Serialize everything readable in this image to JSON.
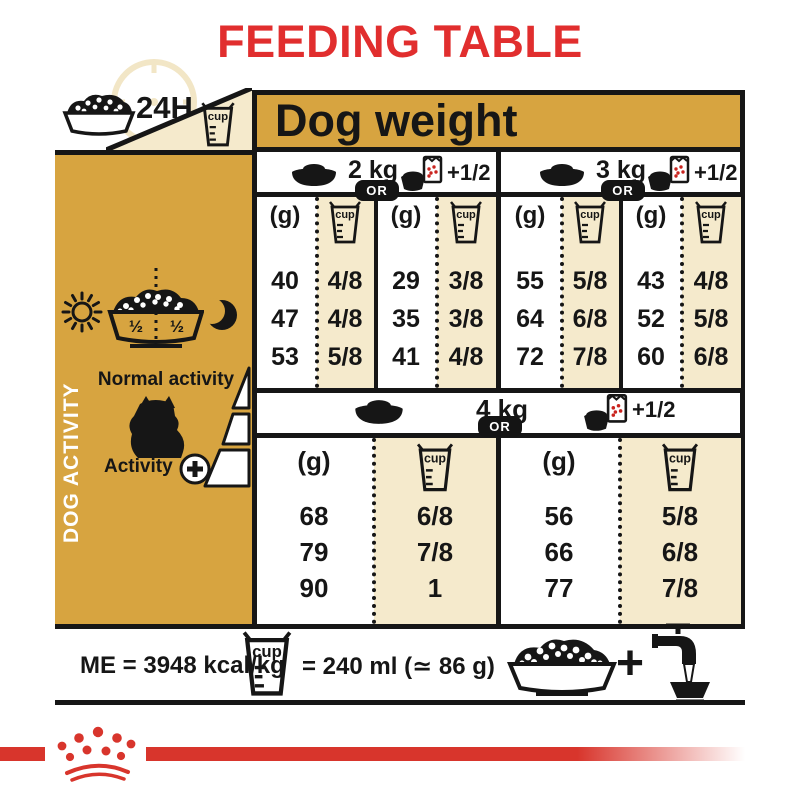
{
  "title": "FEEDING TABLE",
  "labels": {
    "hours": "24H",
    "cup": "cup",
    "dog_weight": "Dog weight",
    "unit_g": "(g)",
    "or": "OR",
    "plus_half": "+1/2",
    "half": "½",
    "plus": "+"
  },
  "sidebar": {
    "vertical_label": "DOG ACTIVITY",
    "normal_activity": "Normal activity",
    "activity": "Activity"
  },
  "feeding": {
    "sections": [
      {
        "weight": "2 kg",
        "pairs": [
          {
            "g": [
              "40",
              "47",
              "53"
            ],
            "cup": [
              "4/8",
              "4/8",
              "5/8"
            ]
          },
          {
            "g": [
              "29",
              "35",
              "41"
            ],
            "cup": [
              "3/8",
              "3/8",
              "4/8"
            ]
          }
        ]
      },
      {
        "weight": "3 kg",
        "pairs": [
          {
            "g": [
              "55",
              "64",
              "72"
            ],
            "cup": [
              "5/8",
              "6/8",
              "7/8"
            ]
          },
          {
            "g": [
              "43",
              "52",
              "60"
            ],
            "cup": [
              "4/8",
              "5/8",
              "6/8"
            ]
          }
        ]
      },
      {
        "weight": "4 kg",
        "pairs": [
          {
            "g": [
              "68",
              "79",
              "90"
            ],
            "cup": [
              "6/8",
              "7/8",
              "1"
            ]
          },
          {
            "g": [
              "56",
              "66",
              "77"
            ],
            "cup": [
              "5/8",
              "6/8",
              "7/8"
            ]
          }
        ]
      }
    ]
  },
  "footer": {
    "me": "ME = 3948 kcal/kg",
    "cup_equivalence": "= 240 ml (≃ 86 g)"
  },
  "colors": {
    "gold": "#D7A440",
    "cream": "#F5EACC",
    "red": "#E12E2E",
    "brand_red": "#D8352C",
    "ink": "#161616"
  },
  "icons": {
    "clock": "clock-24h-icon",
    "kibble_bowl": "kibble-bowl-icon",
    "measuring_cup": "measuring-cup-icon",
    "dish": "dish-icon",
    "pouch": "pouch-and-bowl-icon",
    "sun": "sun-icon",
    "moon": "moon-icon",
    "dog": "dog-silhouette-icon",
    "plus_circle": "plus-circle-icon",
    "water_tap": "water-tap-icon",
    "crown": "crown-logo"
  }
}
